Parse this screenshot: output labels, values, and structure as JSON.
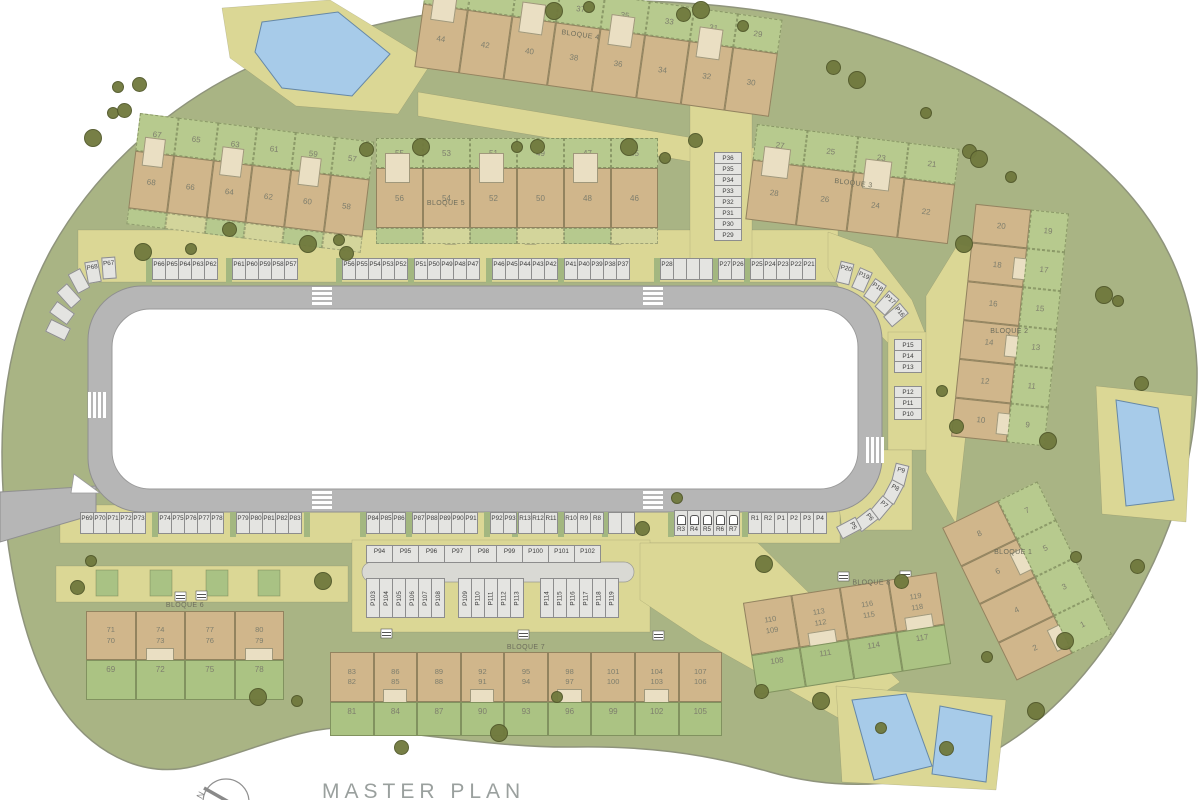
{
  "title": "MASTER PLAN",
  "compass": {
    "north_label": "N"
  },
  "colors": {
    "site_green": "#a9b484",
    "garden_green": "#b7ca8e",
    "lawn_green": "#abc383",
    "path_khaki": "#dbd795",
    "building_tan": "#d0b68b",
    "unit_cream": "#eadfc3",
    "parking_gray": "#e4e4e1",
    "road_gray": "#b6b6b6",
    "pool_blue": "#a7cbe9",
    "tree_olive": "#70793d"
  },
  "blocks": [
    {
      "id": "bloque-5",
      "label": "BLOQUE 5",
      "segments": [
        {
          "top": [
            "67",
            "65",
            "63",
            "61",
            "59",
            "57"
          ],
          "bottom": [
            "68",
            "66",
            "64",
            "62",
            "60",
            "58"
          ]
        },
        {
          "top": [
            "55",
            "53",
            "51",
            "49",
            "47",
            "45"
          ],
          "bottom": [
            "56",
            "54",
            "52",
            "50",
            "48",
            "46"
          ]
        }
      ]
    },
    {
      "id": "bloque-4",
      "label": "BLOQUE 4",
      "top": [
        "",
        "",
        "",
        "37",
        "35",
        "33",
        "31",
        "29"
      ],
      "bottom": [
        "44",
        "42",
        "40",
        "38",
        "36",
        "34",
        "32",
        "30"
      ]
    },
    {
      "id": "bloque-3",
      "label": "BLOQUE 3",
      "top": [
        "27",
        "25",
        "23",
        "21"
      ],
      "bottom": [
        "28",
        "26",
        "24",
        "22"
      ]
    },
    {
      "id": "bloque-2",
      "label": "BLOQUE 2",
      "left": [
        "20",
        "18",
        "16",
        "14",
        "12",
        "10"
      ],
      "right": [
        "19",
        "17",
        "15",
        "13",
        "11",
        "9"
      ]
    },
    {
      "id": "bloque-1",
      "label": "BLOQUE 1",
      "left": [
        "8",
        "6",
        "4",
        "2"
      ],
      "right": [
        "7",
        "5",
        "3",
        "1"
      ]
    },
    {
      "id": "bloque-6",
      "label": "BLOQUE 6",
      "pairs": [
        [
          "71",
          "70"
        ],
        [
          "74",
          "73"
        ],
        [
          "77",
          "76"
        ],
        [
          "80",
          "79"
        ]
      ],
      "garden": [
        "69",
        "72",
        "75",
        "78"
      ]
    },
    {
      "id": "bloque-7",
      "label": "BLOQUE 7",
      "pairs": [
        [
          "83",
          "82"
        ],
        [
          "86",
          "85"
        ],
        [
          "89",
          "88"
        ],
        [
          "92",
          "91"
        ],
        [
          "95",
          "94"
        ],
        [
          "98",
          "97"
        ],
        [
          "101",
          "100"
        ],
        [
          "104",
          "103"
        ],
        [
          "107",
          "106"
        ]
      ],
      "garden": [
        "81",
        "84",
        "87",
        "90",
        "93",
        "96",
        "99",
        "102",
        "105"
      ]
    },
    {
      "id": "bloque-8",
      "label": "BLOQUE 8",
      "pairs": [
        [
          "110",
          "109"
        ],
        [
          "113",
          "112"
        ],
        [
          "116",
          "115"
        ],
        [
          "119",
          "118"
        ]
      ],
      "garden": [
        "108",
        "111",
        "114",
        "117"
      ]
    }
  ],
  "parking": {
    "left_curve": [
      "P68",
      "P67",
      "",
      "",
      "",
      ""
    ],
    "top_groups": [
      [
        "P66",
        "P65",
        "P64",
        "P63",
        "P62"
      ],
      [
        "P61",
        "P60",
        "P59",
        "P58",
        "P57"
      ],
      [
        "P56",
        "P55",
        "P54",
        "P53",
        "P52"
      ],
      [
        "P51",
        "P50",
        "P49",
        "P48",
        "P47"
      ],
      [
        "P46",
        "P45",
        "P44",
        "P43",
        "P42"
      ],
      [
        "P41",
        "P40",
        "P39",
        "P38",
        "P37"
      ],
      [
        "P28",
        "",
        "",
        ""
      ],
      [
        "P27",
        "P26"
      ],
      [
        "P25",
        "P24",
        "P23",
        "P22",
        "P21"
      ]
    ],
    "top_curve": [
      "P20",
      "P19",
      "P18",
      "P17",
      "P16"
    ],
    "right_column": [
      "P36",
      "P35",
      "P34",
      "P33",
      "P32",
      "P31",
      "P30",
      "P29"
    ],
    "mid_column_upper": [
      "P15",
      "P14",
      "P13"
    ],
    "mid_column_lower": [
      "P12",
      "P11",
      "P10"
    ],
    "right_curve": [
      "P9",
      "P8",
      "P7",
      "P6",
      "P5"
    ],
    "bottom_groups": [
      [
        "P69",
        "P70",
        "P71",
        "P72",
        "P73"
      ],
      [
        "P74",
        "P75",
        "P76",
        "P77",
        "P78"
      ],
      [
        "P79",
        "P80",
        "P81",
        "P82",
        "P83"
      ],
      [
        "P84",
        "P85",
        "P86"
      ],
      [
        "P87",
        "P88",
        "P89",
        "P90",
        "P91"
      ],
      [
        "P92",
        "P93"
      ],
      [
        "R13",
        "R12",
        "R11"
      ],
      [
        "R10",
        "R9",
        "R8"
      ],
      [
        "",
        ""
      ]
    ],
    "ev_group": [
      "R3",
      "R4",
      "R5",
      "R6",
      "R7"
    ],
    "bottom_right_group": [
      "R1",
      "R2",
      "P1",
      "P2",
      "P3",
      "P4"
    ],
    "p94_row": [
      "P94",
      "P95",
      "P96",
      "P97",
      "P98",
      "P99",
      "P100",
      "P101",
      "P102"
    ],
    "p103_groups": [
      [
        "P103",
        "P104",
        "P105",
        "P106",
        "P107",
        "P108"
      ],
      [
        "P109",
        "P110",
        "P111",
        "P112",
        "P113"
      ],
      [
        "P114",
        "P115",
        "P116",
        "P117",
        "P118",
        "P119"
      ]
    ]
  }
}
